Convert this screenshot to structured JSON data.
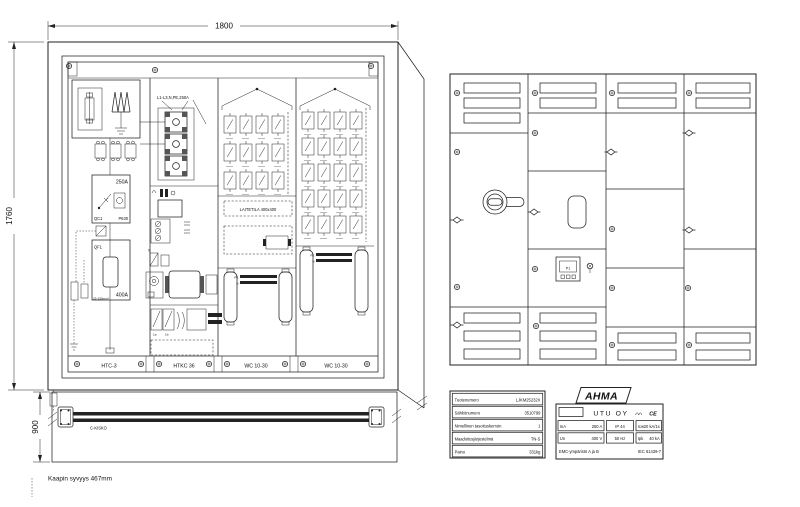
{
  "left_drawing": {
    "dim_width": "1800",
    "dim_height": "1760",
    "dim_base_height": "900",
    "depth_note": "Kaapin syvyys 467mm",
    "rail_label": "C-KISKO",
    "section_labels": [
      "HTC-3",
      "HTKC 36",
      "WC 10-30",
      "WC 10-30"
    ],
    "feed_label": "L1-L3,N,PE,250A",
    "main_switch": {
      "rating": "250A",
      "id": "QC1",
      "type": "P630"
    },
    "main_breaker": {
      "id": "QF1",
      "rating": "400A",
      "cable_note": "25-150mm²"
    },
    "equipment_space_label": "LAITETILA  400x400",
    "busbar_labels": {
      "pe": "PE",
      "n": "N"
    },
    "aux_label": "S",
    "strip_labels": [
      "1a",
      "1b"
    ],
    "outgoing_grids": [
      {
        "rows": 3,
        "cols": 4
      },
      {
        "rows": 5,
        "cols": 4
      }
    ]
  },
  "front_view": {
    "meter_label": "P1"
  },
  "product_table": {
    "rows": [
      {
        "label": "Tuotenumero",
        "value": "LJKM25232X"
      },
      {
        "label": "Sähkönumero",
        "value": "3510799"
      },
      {
        "label": "Nimellinen tasoituskerroin",
        "value": "1"
      },
      {
        "label": "Maadoitusjärjestelmä",
        "value": "TN-S"
      },
      {
        "label": "Paino",
        "value": "331kg"
      }
    ]
  },
  "rating_plate": {
    "brand": "AHMA",
    "company": "UTU OY",
    "ce_mark": "CE",
    "cells": [
      [
        {
          "k": "InA",
          "v": "250 A"
        },
        {
          "k": "",
          "v": "IP 44"
        },
        {
          "k": "Icw",
          "v": "20 kA/1s"
        }
      ],
      [
        {
          "k": "Un",
          "v": "400 V"
        },
        {
          "k": "",
          "v": "50 Hz"
        },
        {
          "k": "Ipk",
          "v": "40 kA"
        }
      ]
    ],
    "footer_left": "EMC-ympäristö  A ja B",
    "footer_right": "IEC 61439-7"
  }
}
